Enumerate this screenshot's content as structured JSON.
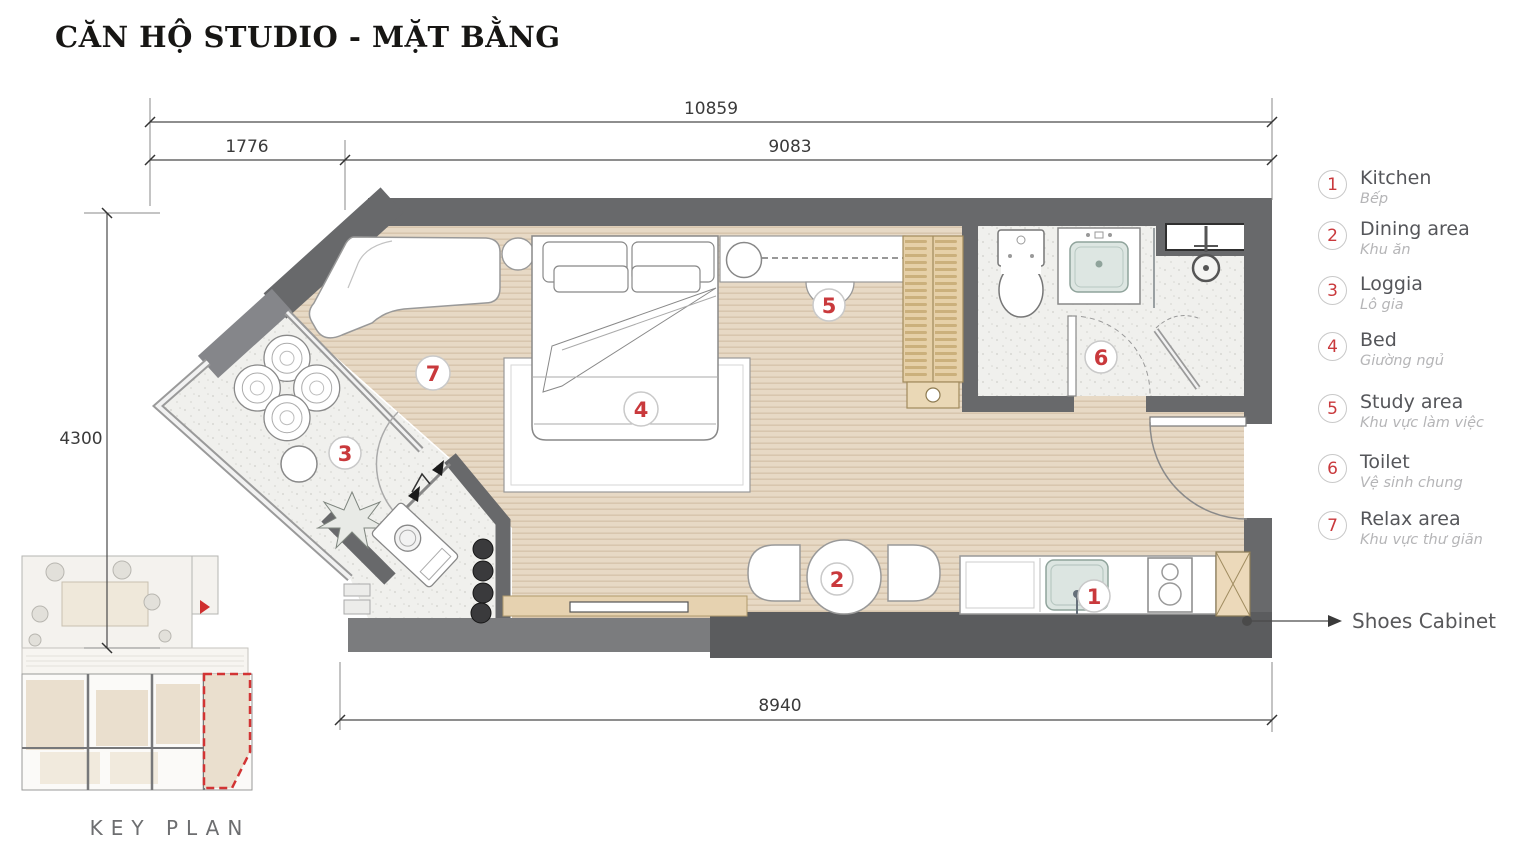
{
  "header": {
    "title": "CĂN HỘ STUDIO - MẶT BẰNG"
  },
  "plan": {
    "dimensions": {
      "overall_width": "10859",
      "left_bay_width": "1776",
      "main_width": "9083",
      "depth": "4300",
      "bottom_width": "8940"
    },
    "annotations": {
      "shoes_cabinet": "Shoes Cabinet"
    }
  },
  "legend": {
    "items": [
      {
        "number": "1",
        "en": "Kitchen",
        "vi": "Bếp"
      },
      {
        "number": "2",
        "en": "Dining area",
        "vi": "Khu ăn"
      },
      {
        "number": "3",
        "en": "Loggia",
        "vi": "Lô gia"
      },
      {
        "number": "4",
        "en": "Bed",
        "vi": "Giường ngủ"
      },
      {
        "number": "5",
        "en": "Study area",
        "vi": "Khu vực làm việc"
      },
      {
        "number": "6",
        "en": "Toilet",
        "vi": "Vệ sinh chung"
      },
      {
        "number": "7",
        "en": "Relax area",
        "vi": "Khu vực thư giãn"
      }
    ]
  },
  "key_plan": {
    "label": "KEY PLAN"
  },
  "colors": {
    "accent_red": "#c9393c",
    "wall_dark": "#636467",
    "wall_medium": "#828387",
    "floor_wood": "#e6d8c4",
    "floor_stone": "#f0f0ee",
    "furniture_beige": "#e6d0a8"
  }
}
